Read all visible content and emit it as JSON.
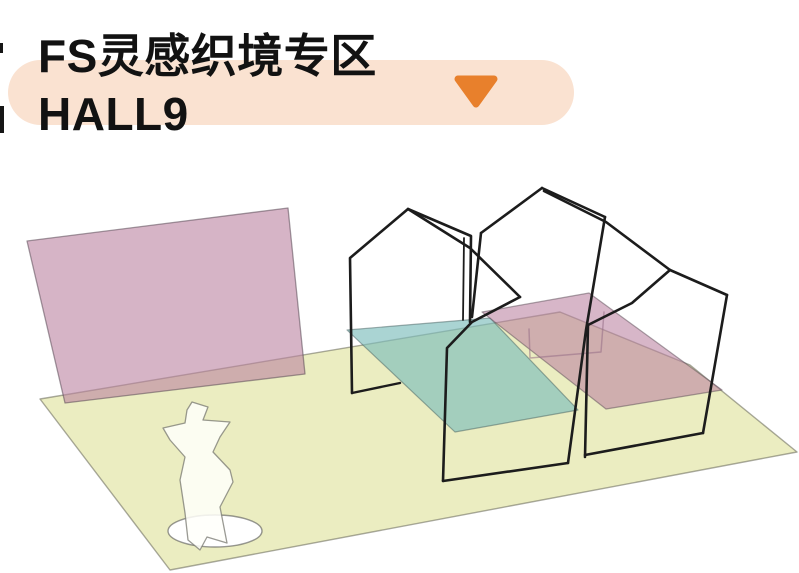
{
  "header": {
    "title_line1": "FS灵感织境专区",
    "title_line2": "HALL9",
    "text_color": "#121212",
    "pill_bg": "#FAE2D1",
    "triangle_color": "#E8802C"
  },
  "scene": {
    "description": "Isometric sketch map of exhibition zone HALL9: yellow floor plane, pink display wall, teal and pink floor mats, three black wireframe house structures, white mannequin on round pedestal",
    "background": "#FFFFFF",
    "colors": {
      "floor_yellow": "rgba(233,236,188,0.92)",
      "mat_teal": "rgba(125,189,188,0.65)",
      "panel_pink": "rgba(186,130,160,0.60)",
      "wireframe_black": "#1C1C1C",
      "outline_gray": "rgba(100,100,85,0.55)"
    },
    "shapes": [
      {
        "name": "floor-plane",
        "type": "polygon",
        "points": "40,399 560,312 690,365 797,452 170,570",
        "fill": "rgba(233,236,188,0.92)",
        "stroke": "rgba(100,100,85,0.55)",
        "sw": 1.4
      },
      {
        "name": "pedestal-ellipse",
        "type": "ellipse",
        "cx": 215,
        "cy": 531,
        "rx": 47,
        "ry": 16,
        "fill": "#FFFFFF",
        "stroke": "rgba(85,85,85,0.6)",
        "sw": 1.4
      },
      {
        "name": "mannequin-figure",
        "type": "polygon",
        "points": "192,402 208,407 203,420 230,422 220,437 213,452 230,470 233,482 220,507 227,543 207,537 200,550 188,540 185,513 180,480 185,457 170,440 163,428 185,423 187,410",
        "fill": "rgba(255,255,250,0.85)",
        "stroke": "rgba(120,120,112,0.75)",
        "sw": 1.3
      },
      {
        "name": "pink-wall-panel",
        "type": "polygon",
        "points": "27,241 288,208 305,374 65,403",
        "fill": "rgba(186,130,160,0.60)",
        "stroke": "rgba(90,75,85,0.55)",
        "sw": 1.3
      },
      {
        "name": "teal-floor-mat",
        "type": "polygon",
        "points": "347,330 490,318 578,410 455,432",
        "fill": "rgba(125,189,188,0.65)",
        "stroke": "rgba(70,95,95,0.5)",
        "sw": 1.2
      },
      {
        "name": "pink-floor-mat",
        "type": "polygon",
        "points": "482,312 589,293 722,390 606,409",
        "fill": "rgba(186,130,160,0.58)",
        "stroke": "rgba(90,75,85,0.5)",
        "sw": 1.2
      },
      {
        "name": "seen-through-edges",
        "type": "polyline",
        "points": "529,329 530,358 601,352 604,312",
        "fill": "none",
        "stroke": "rgba(150,110,135,0.55)",
        "sw": 1.5
      },
      {
        "name": "house-left-outline",
        "type": "polyline",
        "points": "352,393 350,258 408,209 471,236 470,322",
        "fill": "none",
        "stroke": "#1C1C1C",
        "sw": 2.6
      },
      {
        "name": "house-left-edge-double",
        "type": "polyline",
        "points": "464,238 463,320",
        "fill": "none",
        "stroke": "#1C1C1C",
        "sw": 1.8
      },
      {
        "name": "house-left-bottom-edge",
        "type": "polyline",
        "points": "352,393 400,383",
        "fill": "none",
        "stroke": "#1C1C1C",
        "sw": 2.4
      },
      {
        "name": "house-left-ridge",
        "type": "polyline",
        "points": "408,209 470,248 520,297",
        "fill": "none",
        "stroke": "#1C1C1C",
        "sw": 2.6
      },
      {
        "name": "house-left-back-edge",
        "type": "polyline",
        "points": "520,297 472,322 447,348 443,481",
        "fill": "none",
        "stroke": "#1C1C1C",
        "sw": 2.6
      },
      {
        "name": "house-middle-left-slope",
        "type": "polyline",
        "points": "542,188 481,233",
        "fill": "none",
        "stroke": "#1C1C1C",
        "sw": 2.6
      },
      {
        "name": "house-middle-left-edge",
        "type": "polyline",
        "points": "481,233 472,317",
        "fill": "none",
        "stroke": "#1C1C1C",
        "sw": 2.6
      },
      {
        "name": "house-middle-right-slope",
        "type": "polyline",
        "points": "542,188 605,217",
        "fill": "none",
        "stroke": "#1C1C1C",
        "sw": 2.6
      },
      {
        "name": "house-middle-right-edge",
        "type": "polyline",
        "points": "605,217 586,330 568,463",
        "fill": "none",
        "stroke": "#1C1C1C",
        "sw": 2.6
      },
      {
        "name": "house-middle-bottom-edge",
        "type": "polyline",
        "points": "443,481 568,463",
        "fill": "none",
        "stroke": "#1C1C1C",
        "sw": 2.6
      },
      {
        "name": "house-middle-ridge",
        "type": "polyline",
        "points": "544,191 606,222 670,270",
        "fill": "none",
        "stroke": "#1C1C1C",
        "sw": 2.6
      },
      {
        "name": "house-right-left-slope",
        "type": "polyline",
        "points": "670,270 632,303 588,325",
        "fill": "none",
        "stroke": "#1C1C1C",
        "sw": 2.6
      },
      {
        "name": "house-right-left-edge",
        "type": "polyline",
        "points": "588,325 585,457",
        "fill": "none",
        "stroke": "#1C1C1C",
        "sw": 2.6
      },
      {
        "name": "house-right-ridge",
        "type": "polyline",
        "points": "670,270 727,295",
        "fill": "none",
        "stroke": "#1C1C1C",
        "sw": 2.6
      },
      {
        "name": "house-right-right-edge",
        "type": "polyline",
        "points": "727,295 703,433",
        "fill": "none",
        "stroke": "#1C1C1C",
        "sw": 2.6
      },
      {
        "name": "house-right-bottom-edge",
        "type": "polyline",
        "points": "703,433 585,455",
        "fill": "none",
        "stroke": "#1C1C1C",
        "sw": 2.6
      },
      {
        "name": "edge-artifact-top",
        "type": "rect",
        "x": 0,
        "y": 43,
        "width": 3,
        "height": 10,
        "fill": "#161616"
      },
      {
        "name": "edge-artifact-bottom",
        "type": "rect",
        "x": 0,
        "y": 106,
        "width": 4,
        "height": 27,
        "fill": "#161616"
      }
    ]
  }
}
